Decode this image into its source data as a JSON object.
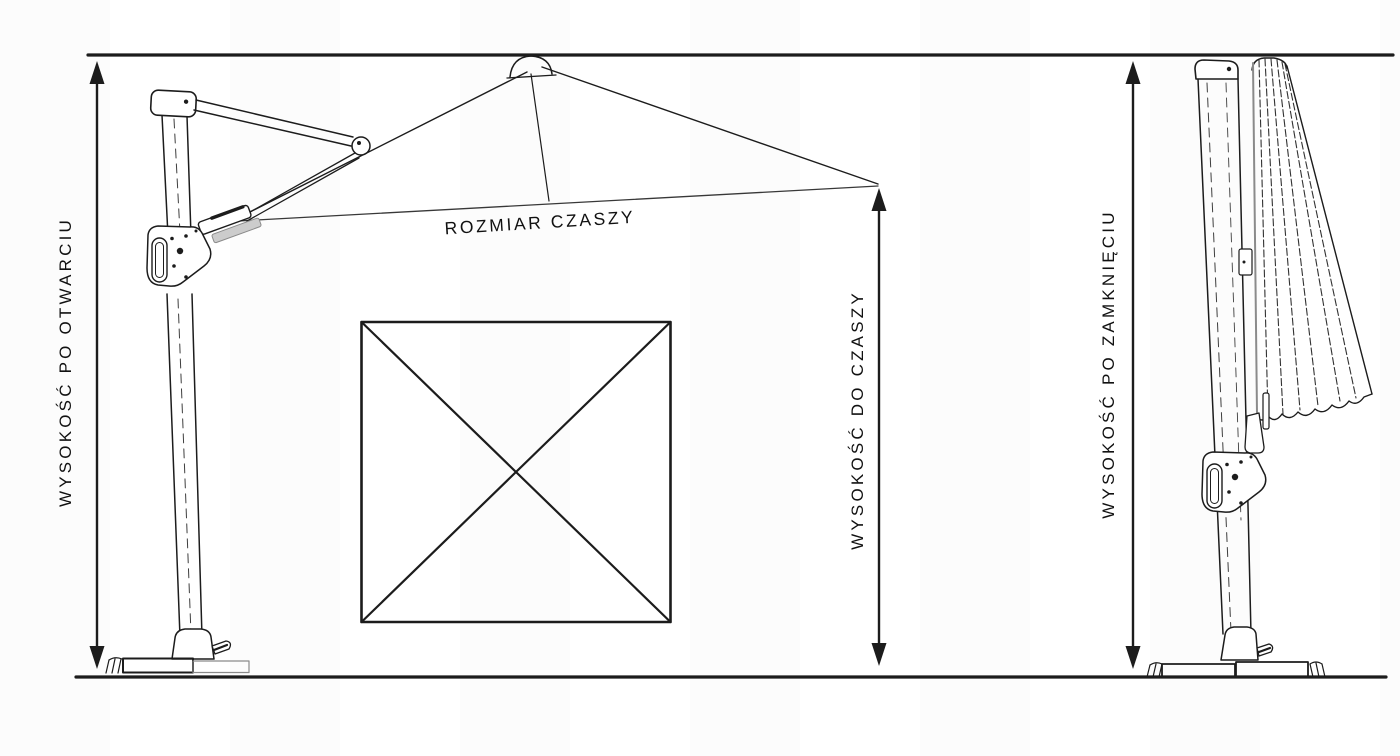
{
  "diagram": {
    "labels": {
      "height_open": "WYSOKOŚĆ PO OTWARCIU",
      "canopy_size": "ROZMIAR CZASZY",
      "height_to_canopy": "WYSOKOŚĆ DO CZASZY",
      "height_closed": "WYSOKOŚĆ PO ZAMKNIĘCIU"
    },
    "colors": {
      "line": "#1c1c1c",
      "background": "#ffffff",
      "shade": "#8a8a8a",
      "text": "#111111"
    }
  }
}
